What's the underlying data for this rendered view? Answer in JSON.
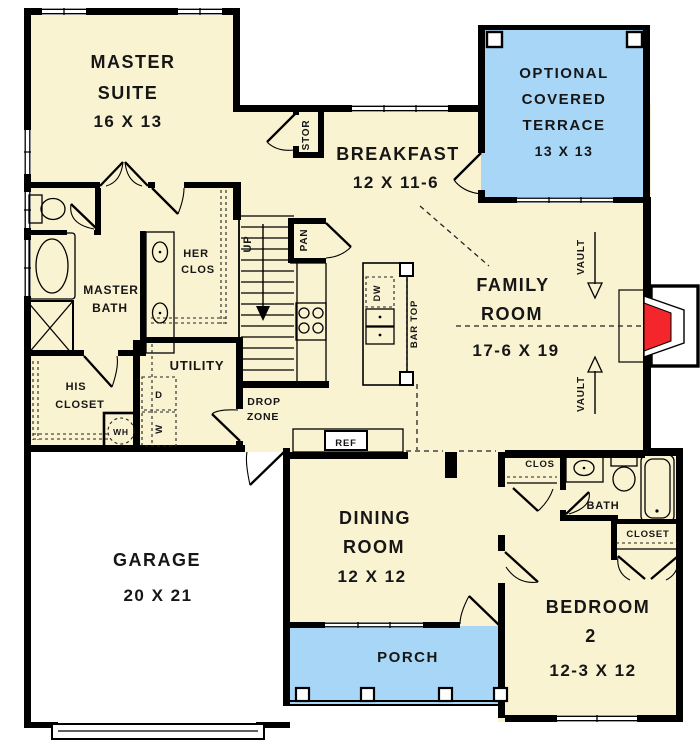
{
  "plan_title": "First Floor Plan",
  "colors": {
    "floor": "#faf3d2",
    "outdoor": "#a7d6f6",
    "wall": "#000000",
    "fireplace": "#f5262b",
    "garage_floor": "#ffffff"
  },
  "rooms": {
    "master_suite": {
      "line1": "MASTER",
      "line2": "SUITE",
      "dims": "16 X 13"
    },
    "optional_covered_terrace": {
      "line1": "OPTIONAL",
      "line2": "COVERED",
      "line3": "TERRACE",
      "dims": "13 X 13"
    },
    "breakfast": {
      "line1": "BREAKFAST",
      "dims": "12 X 11-6"
    },
    "family_room": {
      "line1": "FAMILY",
      "line2": "ROOM",
      "dims": "17-6 X 19"
    },
    "dining_room": {
      "line1": "DINING",
      "line2": "ROOM",
      "dims": "12 X 12"
    },
    "garage": {
      "line1": "GARAGE",
      "dims": "20 X 21"
    },
    "bedroom_2": {
      "line1": "BEDROOM",
      "line2": "2",
      "dims": "12-3 X 12"
    },
    "porch": {
      "line1": "PORCH"
    },
    "utility": {
      "line1": "UTILITY"
    },
    "master_bath": {
      "line1": "MASTER",
      "line2": "BATH"
    },
    "his_closet": {
      "line1": "HIS",
      "line2": "CLOSET"
    },
    "her_closet": {
      "line1": "HER",
      "line2": "CLOS"
    },
    "drop_zone": {
      "line1": "DROP",
      "line2": "ZONE"
    },
    "bath": {
      "line1": "BATH"
    },
    "clos": {
      "line1": "CLOS"
    },
    "closet": {
      "line1": "CLOSET"
    }
  },
  "annotations": {
    "stor": "STOR",
    "pan": "PAN",
    "bar_top": "BAR TOP",
    "ref": "REF",
    "dw": "DW",
    "dryer": "D",
    "washer": "W",
    "water_heater": "WH",
    "stairs_up": "UP",
    "vault": "VAULT"
  }
}
